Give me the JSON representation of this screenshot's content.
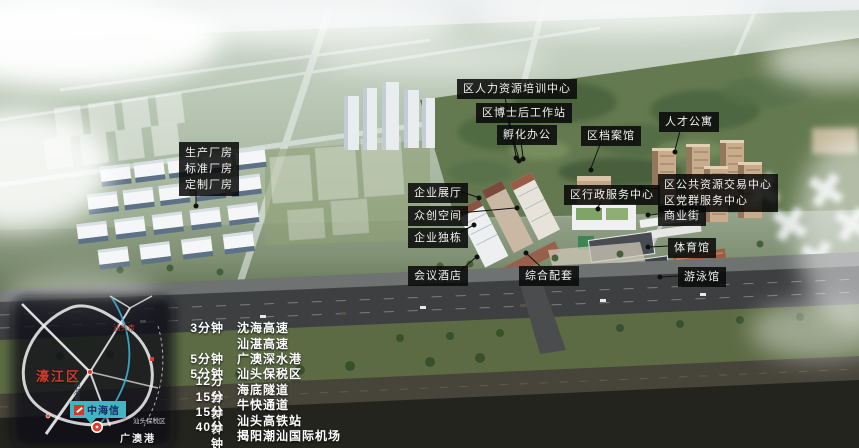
{
  "callouts": {
    "factory": {
      "lines": [
        "生产厂房",
        "标准厂房",
        "定制厂房"
      ]
    },
    "hr_training": "区人力资源培训中心",
    "postdoc": "区博士后工作站",
    "incubation": "孵化办公",
    "archives": "区档案馆",
    "talent_apartment": "人才公寓",
    "exhibition": "企业展厅",
    "makerspace": "众创空间",
    "standalone": "企业独栋",
    "hotel": "会议酒店",
    "amenities": "综合配套",
    "admin_center": "区行政服务中心",
    "public_resource": {
      "lines": [
        "区公共资源交易中心",
        "区党群服务中心"
      ]
    },
    "commercial_street": "商业街",
    "gymnasium": "体育馆",
    "swimming": "游泳馆"
  },
  "legend": {
    "rows": [
      {
        "time": "3分钟",
        "dest": "沈海高速"
      },
      {
        "time": "",
        "dest": "汕湛高速"
      },
      {
        "time": "5分钟",
        "dest": "广澳深水港"
      },
      {
        "time": "5分钟",
        "dest": "汕头保税区"
      },
      {
        "time": "12分钟",
        "dest": "海底隧道"
      },
      {
        "time": "15分钟",
        "dest": "牛快通道"
      },
      {
        "time": "15分钟",
        "dest": "汕头高铁站"
      },
      {
        "time": "40分钟",
        "dest": "揭阳潮汕国际机场"
      }
    ]
  },
  "minimap": {
    "city": "汕头市",
    "district": "濠江区",
    "expressway": "汕湛高速",
    "bonded_zone": "汕头保税区",
    "port": "广澳港",
    "brand": "中海信",
    "marker_icon": "location-pin"
  },
  "colors": {
    "label_bg": "#0a0a0a",
    "label_text": "#f2f2f2",
    "brand_teal": "#45b4c2",
    "brand_red": "#d6352a",
    "map_red": "#d03a2c"
  }
}
